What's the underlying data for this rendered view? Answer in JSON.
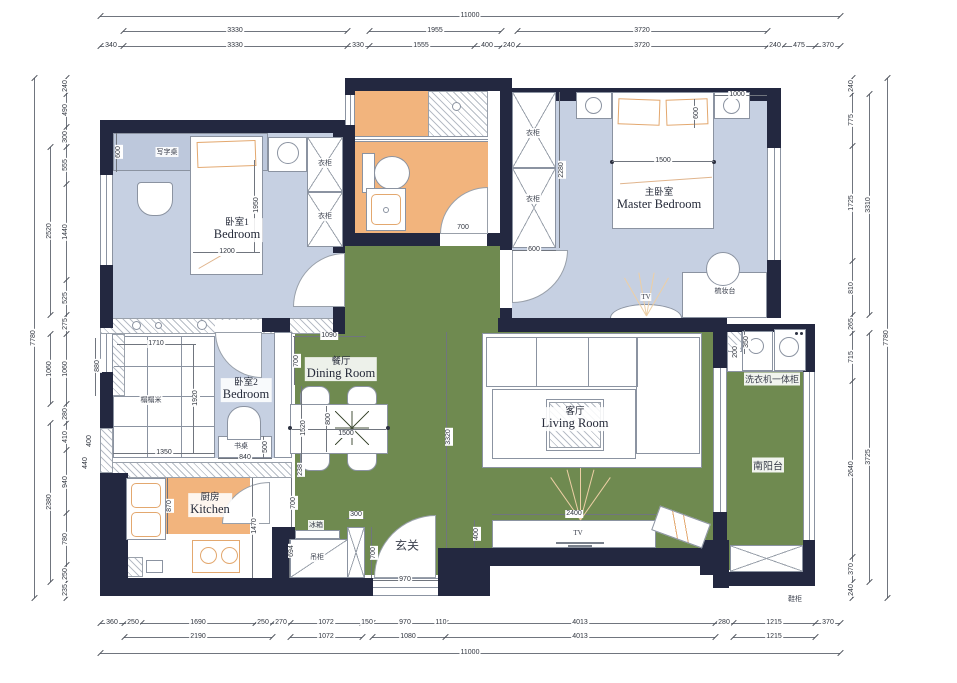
{
  "colors": {
    "wall": "#232840",
    "floor_bedroom": "#c6d0e2",
    "floor_hall": "#6f8a50",
    "floor_wet": "#f2b47d"
  },
  "dimensions": {
    "top1": [
      "11000"
    ],
    "top2": [
      "3330",
      "1955",
      "3720"
    ],
    "top3": [
      "340",
      "3330",
      "330",
      "1555",
      "400",
      "240",
      "3720",
      "240",
      "475",
      "370"
    ],
    "bottom1": [
      "360",
      "250",
      "1690",
      "250",
      "270",
      "1072",
      "150",
      "970",
      "110",
      "4013",
      "280",
      "1215",
      "370"
    ],
    "bottom2": [
      "2190",
      "1072",
      "1080",
      "4013",
      "1215"
    ],
    "bottom3": [
      "11000"
    ],
    "left_inner": [
      "240",
      "490",
      "300",
      "555",
      "1440",
      "525",
      "275",
      "1060",
      "280",
      "410",
      "940",
      "780",
      "250",
      "235"
    ],
    "left_mid": [
      "2520",
      "1060",
      "2380"
    ],
    "left_outer": [
      "7780"
    ],
    "right_inner": [
      "240",
      "775",
      "1725",
      "810",
      "265",
      "715",
      "2640",
      "370",
      "240"
    ],
    "right_mid": [
      "3310",
      "3725"
    ],
    "right_outer": [
      "7780"
    ]
  },
  "plan_dims": [
    {
      "t": "600",
      "x": 119,
      "y": 152,
      "r": 1
    },
    {
      "t": "1950",
      "x": 257,
      "y": 205,
      "r": 1
    },
    {
      "t": "1200",
      "x": 227,
      "y": 252,
      "r": 0
    },
    {
      "t": "700",
      "x": 463,
      "y": 228,
      "r": 0
    },
    {
      "t": "2280",
      "x": 562,
      "y": 170,
      "r": 1
    },
    {
      "t": "600",
      "x": 534,
      "y": 250,
      "r": 0
    },
    {
      "t": "1000",
      "x": 737,
      "y": 95,
      "r": 0
    },
    {
      "t": "600",
      "x": 697,
      "y": 113,
      "r": 1
    },
    {
      "t": "1500",
      "x": 663,
      "y": 161,
      "r": 0
    },
    {
      "t": "1710",
      "x": 156,
      "y": 344,
      "r": 0
    },
    {
      "t": "1920",
      "x": 196,
      "y": 398,
      "r": 1
    },
    {
      "t": "1350",
      "x": 164,
      "y": 453,
      "r": 0
    },
    {
      "t": "880",
      "x": 98,
      "y": 366,
      "r": 1
    },
    {
      "t": "400",
      "x": 90,
      "y": 441,
      "r": 1
    },
    {
      "t": "440",
      "x": 86,
      "y": 463,
      "r": 1
    },
    {
      "t": "840",
      "x": 245,
      "y": 458,
      "r": 0
    },
    {
      "t": "500",
      "x": 266,
      "y": 447,
      "r": 1
    },
    {
      "t": "1090",
      "x": 329,
      "y": 336,
      "r": 0
    },
    {
      "t": "700",
      "x": 297,
      "y": 361,
      "r": 1
    },
    {
      "t": "1520",
      "x": 304,
      "y": 428,
      "r": 1
    },
    {
      "t": "800",
      "x": 329,
      "y": 419,
      "r": 1
    },
    {
      "t": "1500",
      "x": 346,
      "y": 434,
      "r": 0
    },
    {
      "t": "238",
      "x": 301,
      "y": 470,
      "r": 1
    },
    {
      "t": "3320",
      "x": 449,
      "y": 437,
      "r": 1
    },
    {
      "t": "870",
      "x": 170,
      "y": 506,
      "r": 1
    },
    {
      "t": "1470",
      "x": 255,
      "y": 526,
      "r": 1
    },
    {
      "t": "700",
      "x": 294,
      "y": 503,
      "r": 1
    },
    {
      "t": "300",
      "x": 356,
      "y": 515,
      "r": 0
    },
    {
      "t": "700",
      "x": 374,
      "y": 553,
      "r": 1
    },
    {
      "t": "694",
      "x": 292,
      "y": 551,
      "r": 1
    },
    {
      "t": "970",
      "x": 405,
      "y": 580,
      "r": 0
    },
    {
      "t": "400",
      "x": 477,
      "y": 534,
      "r": 1
    },
    {
      "t": "2400",
      "x": 574,
      "y": 514,
      "r": 0
    },
    {
      "t": "350",
      "x": 747,
      "y": 342,
      "r": 1
    },
    {
      "t": "200",
      "x": 736,
      "y": 352,
      "r": 1
    }
  ],
  "rooms": [
    {
      "zh": "卧室1",
      "en": "Bedroom",
      "x": 237,
      "y": 230
    },
    {
      "zh": "主卧室",
      "en": "Master Bedroom",
      "x": 659,
      "y": 200
    },
    {
      "zh": "卧室2",
      "en": "Bedroom",
      "x": 246,
      "y": 390
    },
    {
      "zh": "餐厅",
      "en": "Dining Room",
      "x": 341,
      "y": 369
    },
    {
      "zh": "客厅",
      "en": "Living Room",
      "x": 575,
      "y": 419
    },
    {
      "zh": "厨房",
      "en": "Kitchen",
      "x": 210,
      "y": 505
    }
  ],
  "labels": [
    {
      "t": "玄关",
      "x": 407,
      "y": 545,
      "fs": 12
    },
    {
      "t": "南阳台",
      "x": 768,
      "y": 465,
      "fs": 10
    },
    {
      "t": "洗衣机一体柜",
      "x": 772,
      "y": 379,
      "fs": 9
    },
    {
      "t": "写字桌",
      "x": 167,
      "y": 152,
      "fs": 7
    },
    {
      "t": "衣柜",
      "x": 325,
      "y": 163,
      "fs": 7
    },
    {
      "t": "衣柜",
      "x": 325,
      "y": 216,
      "fs": 7
    },
    {
      "t": "衣柜",
      "x": 533,
      "y": 133,
      "fs": 7
    },
    {
      "t": "衣柜",
      "x": 533,
      "y": 199,
      "fs": 7
    },
    {
      "t": "梳妆台",
      "x": 725,
      "y": 291,
      "fs": 7
    },
    {
      "t": "TV",
      "x": 646,
      "y": 297,
      "fs": 7
    },
    {
      "t": "TV",
      "x": 578,
      "y": 533,
      "fs": 7
    },
    {
      "t": "榻榻米",
      "x": 151,
      "y": 400,
      "fs": 7
    },
    {
      "t": "书桌",
      "x": 241,
      "y": 446,
      "fs": 7
    },
    {
      "t": "冰箱",
      "x": 316,
      "y": 525,
      "fs": 7
    },
    {
      "t": "吊柜",
      "x": 317,
      "y": 557,
      "fs": 7
    },
    {
      "t": "鞋柜",
      "x": 795,
      "y": 599,
      "fs": 7
    }
  ]
}
